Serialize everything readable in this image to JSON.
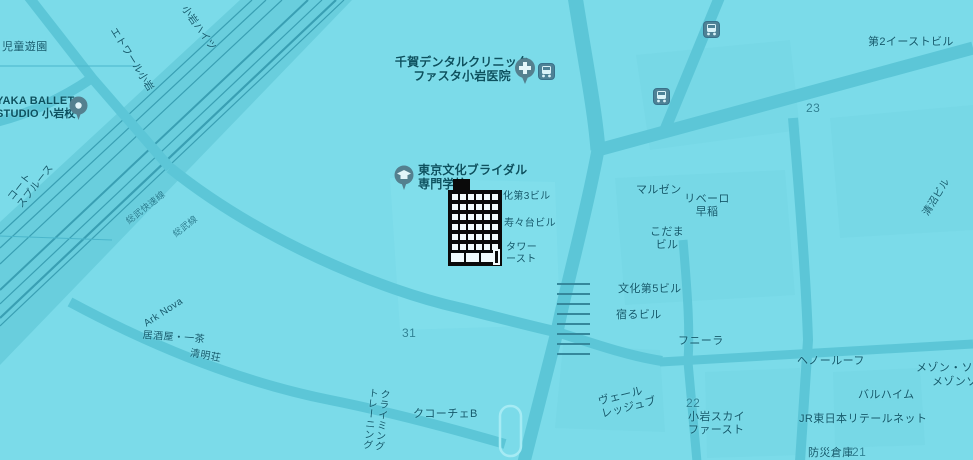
{
  "map": {
    "colors": {
      "background": "#7bdbe9",
      "road": "#5cc6d7",
      "railway_band": "#69cedd",
      "rail_line": "#2e94a9",
      "label_text": "#14596b",
      "block_number_text": "#2f8294",
      "pin_fill": "#54808f",
      "pin_glyph": "#e2f5f9",
      "building_marker": "#0a0a0a"
    },
    "labels": [
      {
        "name": "jido-yuen",
        "lines": [
          "児童遊園"
        ],
        "x": 2,
        "y": 41,
        "fs": 11
      },
      {
        "name": "ballet-studio",
        "lines": [
          "YAKA BALLET",
          "STUDIO 小岩校"
        ],
        "x": -4,
        "y": 95,
        "fs": 11,
        "poi": true,
        "interactable": true
      },
      {
        "name": "court-spruce",
        "lines": [
          "コート",
          "スプルース"
        ],
        "x": 6,
        "y": 196,
        "rot": -52,
        "fs": 10
      },
      {
        "name": "etoile-koiwa",
        "lines": [
          "エトワール小岩"
        ],
        "x": 117,
        "y": 26,
        "rot": 58,
        "fs": 10
      },
      {
        "name": "koiwa-heights",
        "lines": [
          "小岩ハイツ"
        ],
        "x": 188,
        "y": 4,
        "rot": 55,
        "fs": 10
      },
      {
        "name": "dental-clinic",
        "lines": [
          "千賀デンタルクリニック",
          "ファスタ小岩医院"
        ],
        "x": 462,
        "y": 55,
        "fs": 12,
        "align": "center",
        "poi": true,
        "interactable": true
      },
      {
        "name": "east-building",
        "lines": [
          "第2イーストビル"
        ],
        "x": 868,
        "y": 36,
        "fs": 11
      },
      {
        "name": "block-23",
        "lines": [
          "23"
        ],
        "x": 806,
        "y": 101,
        "fs": 12,
        "num": true
      },
      {
        "name": "maruzen",
        "lines": [
          "マルゼン"
        ],
        "x": 636,
        "y": 184,
        "fs": 11
      },
      {
        "name": "ribero",
        "lines": [
          "リベーロ",
          "早稲"
        ],
        "x": 707,
        "y": 193,
        "fs": 11,
        "align": "center"
      },
      {
        "name": "kodama-building",
        "lines": [
          "こだま",
          "ビル"
        ],
        "x": 667,
        "y": 226,
        "fs": 11,
        "align": "center"
      },
      {
        "name": "kiyonuma-building",
        "lines": [
          "清沼ビル"
        ],
        "x": 921,
        "y": 212,
        "rot": -58,
        "fs": 10
      },
      {
        "name": "bridal-school",
        "lines": [
          "東京文化ブライダル",
          "専門学校"
        ],
        "x": 418,
        "y": 163,
        "fs": 12,
        "poi": true,
        "interactable": true
      },
      {
        "name": "bunka-3-building",
        "lines": [
          "化第3ビル"
        ],
        "x": 503,
        "y": 191,
        "fs": 10
      },
      {
        "name": "suzudai-building",
        "lines": [
          "寿々台ビル"
        ],
        "x": 504,
        "y": 218,
        "fs": 10
      },
      {
        "name": "tower-east",
        "lines": [
          "タワー",
          "ースト"
        ],
        "x": 506,
        "y": 242,
        "fs": 10
      },
      {
        "name": "bunka-5-building",
        "lines": [
          "文化第5ビル"
        ],
        "x": 618,
        "y": 283,
        "fs": 11
      },
      {
        "name": "yadoru-building",
        "lines": [
          "宿るビル"
        ],
        "x": 616,
        "y": 309,
        "fs": 11
      },
      {
        "name": "funira",
        "lines": [
          "フニーラ"
        ],
        "x": 678,
        "y": 335,
        "fs": 11
      },
      {
        "name": "heno-roof",
        "lines": [
          "ヘノールーフ"
        ],
        "x": 797,
        "y": 355,
        "fs": 11
      },
      {
        "name": "maison-sofia",
        "lines": [
          "メゾン・ソフィ"
        ],
        "x": 916,
        "y": 362,
        "fs": 11
      },
      {
        "name": "maison-sof-2",
        "lines": [
          "メゾンソフィ"
        ],
        "x": 932,
        "y": 376,
        "fs": 11
      },
      {
        "name": "haruheim",
        "lines": [
          "バルハイム"
        ],
        "x": 858,
        "y": 389,
        "fs": 11
      },
      {
        "name": "jr-east-retail-net",
        "lines": [
          "JR東日本リテールネット"
        ],
        "x": 799,
        "y": 413,
        "fs": 11
      },
      {
        "name": "bousai-souko",
        "lines": [
          "防災倉庫"
        ],
        "x": 808,
        "y": 447,
        "fs": 11
      },
      {
        "name": "block-21",
        "lines": [
          "21"
        ],
        "x": 852,
        "y": 445,
        "fs": 12,
        "num": true
      },
      {
        "name": "block-22",
        "lines": [
          "22"
        ],
        "x": 686,
        "y": 396,
        "fs": 12,
        "num": true
      },
      {
        "name": "koiwa-sky-first",
        "lines": [
          "小岩スカイ",
          "ファースト"
        ],
        "x": 688,
        "y": 411,
        "fs": 11
      },
      {
        "name": "veil-ledge",
        "lines": [
          "ヴェール",
          "レッジュブ"
        ],
        "x": 597,
        "y": 396,
        "rot": -14,
        "fs": 11
      },
      {
        "name": "block-31",
        "lines": [
          "31"
        ],
        "x": 402,
        "y": 326,
        "fs": 12,
        "num": true
      },
      {
        "name": "cucoche-b",
        "lines": [
          "クコーチェB"
        ],
        "x": 413,
        "y": 408,
        "fs": 11
      },
      {
        "name": "climbing-gym",
        "lines": [
          "クライミング",
          "トレーニング"
        ],
        "x": 366,
        "y": 387,
        "fs": 10,
        "vertical": true,
        "rot": 6
      },
      {
        "name": "izakaya-issa",
        "lines": [
          "居酒屋・一茶"
        ],
        "x": 143,
        "y": 330,
        "rot": 4,
        "fs": 10
      },
      {
        "name": "seimei-so",
        "lines": [
          "清明荘"
        ],
        "x": 191,
        "y": 348,
        "rot": 10,
        "fs": 10
      },
      {
        "name": "sobu-rapid-line",
        "lines": [
          "総武快速線"
        ],
        "x": 124,
        "y": 218,
        "rot": -38,
        "fs": 9,
        "rail": true
      },
      {
        "name": "sobu-line",
        "lines": [
          "総武線"
        ],
        "x": 171,
        "y": 231,
        "rot": -38,
        "fs": 9,
        "rail": true
      },
      {
        "name": "ark-nova",
        "lines": [
          "Ark Nova"
        ],
        "x": 142,
        "y": 320,
        "rot": -33,
        "fs": 10
      }
    ],
    "icons": [
      {
        "name": "hospital-pin-icon",
        "type": "hospital",
        "x": 514,
        "y": 57
      },
      {
        "name": "transit-stop-icon",
        "type": "transit",
        "x": 538,
        "y": 63
      },
      {
        "name": "transit-stop-icon-2",
        "type": "transit",
        "x": 653,
        "y": 88
      },
      {
        "name": "transit-stop-icon-3",
        "type": "transit",
        "x": 703,
        "y": 21
      },
      {
        "name": "school-pin-icon",
        "type": "school",
        "x": 394,
        "y": 165
      },
      {
        "name": "place-pin-icon",
        "type": "place",
        "x": 69,
        "y": 96
      }
    ],
    "building_marker": {
      "name": "building-icon",
      "x": 447,
      "y": 177
    }
  }
}
